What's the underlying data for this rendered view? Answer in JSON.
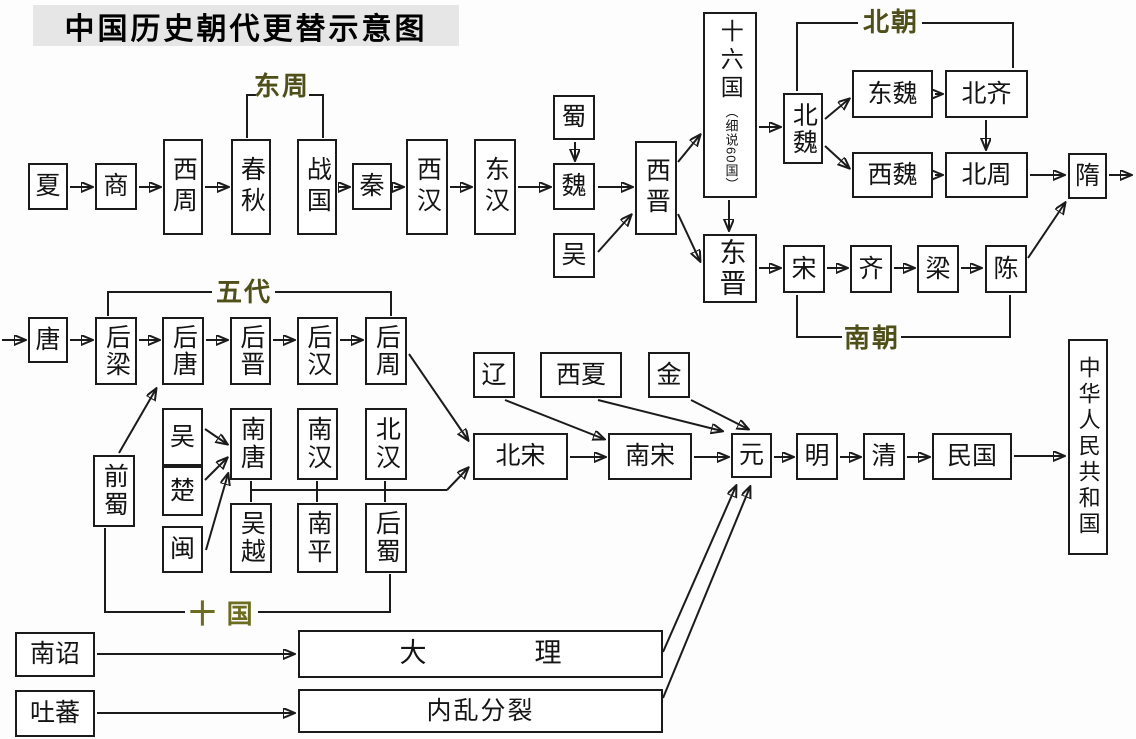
{
  "title": "中国历史朝代更替示意图",
  "colors": {
    "bg": "#fdfdfd",
    "line": "#1b1b1b",
    "title_bg": "#e6e6e6",
    "label_olive": "#4f4f1a",
    "label_olive_light": "#6d6d22"
  },
  "group_labels": {
    "dongzhou": "东周",
    "beichao": "北朝",
    "nanchao": "南朝",
    "wudai": "五代",
    "shiguo": "十 国"
  },
  "nodes": {
    "xia": "夏",
    "shang": "商",
    "xizhou": "西周",
    "chunqiu": "春秋",
    "zhanguo": "战国",
    "qin": "秦",
    "xihan": "西汉",
    "donghan": "东汉",
    "shu": "蜀",
    "wei": "魏",
    "wu": "吴",
    "xijin": "西晋",
    "dongjin": "东晋",
    "beiwei": "北魏",
    "dongwei": "东魏",
    "beiqi": "北齐",
    "xiwei": "西魏",
    "beizhou": "北周",
    "sui": "隋",
    "song": "宋",
    "qi": "齐",
    "liang": "梁",
    "chen": "陈",
    "tang": "唐",
    "houliang": "后梁",
    "houtang": "后唐",
    "houjin": "后晋",
    "houhan": "后汉",
    "houzhou": "后周",
    "qianshu": "前蜀",
    "wu_state": "吴",
    "chu": "楚",
    "min": "闽",
    "nantang": "南唐",
    "nanhan": "南汉",
    "beihan": "北汉",
    "wuyue": "吴越",
    "nanping": "南平",
    "houshu": "后蜀",
    "liao": "辽",
    "xixia": "西夏",
    "jin": "金",
    "beisong": "北宋",
    "nansong": "南宋",
    "yuan": "元",
    "ming": "明",
    "qing": "清",
    "minguo": "民国",
    "prc": "中华人民共和国",
    "nanzhao": "南诏",
    "dali": "大　　　　理",
    "tubo": "吐蕃",
    "neiluan": "内乱分裂"
  },
  "nodes16": {
    "label": "十六国",
    "note": "（细说60国）"
  }
}
